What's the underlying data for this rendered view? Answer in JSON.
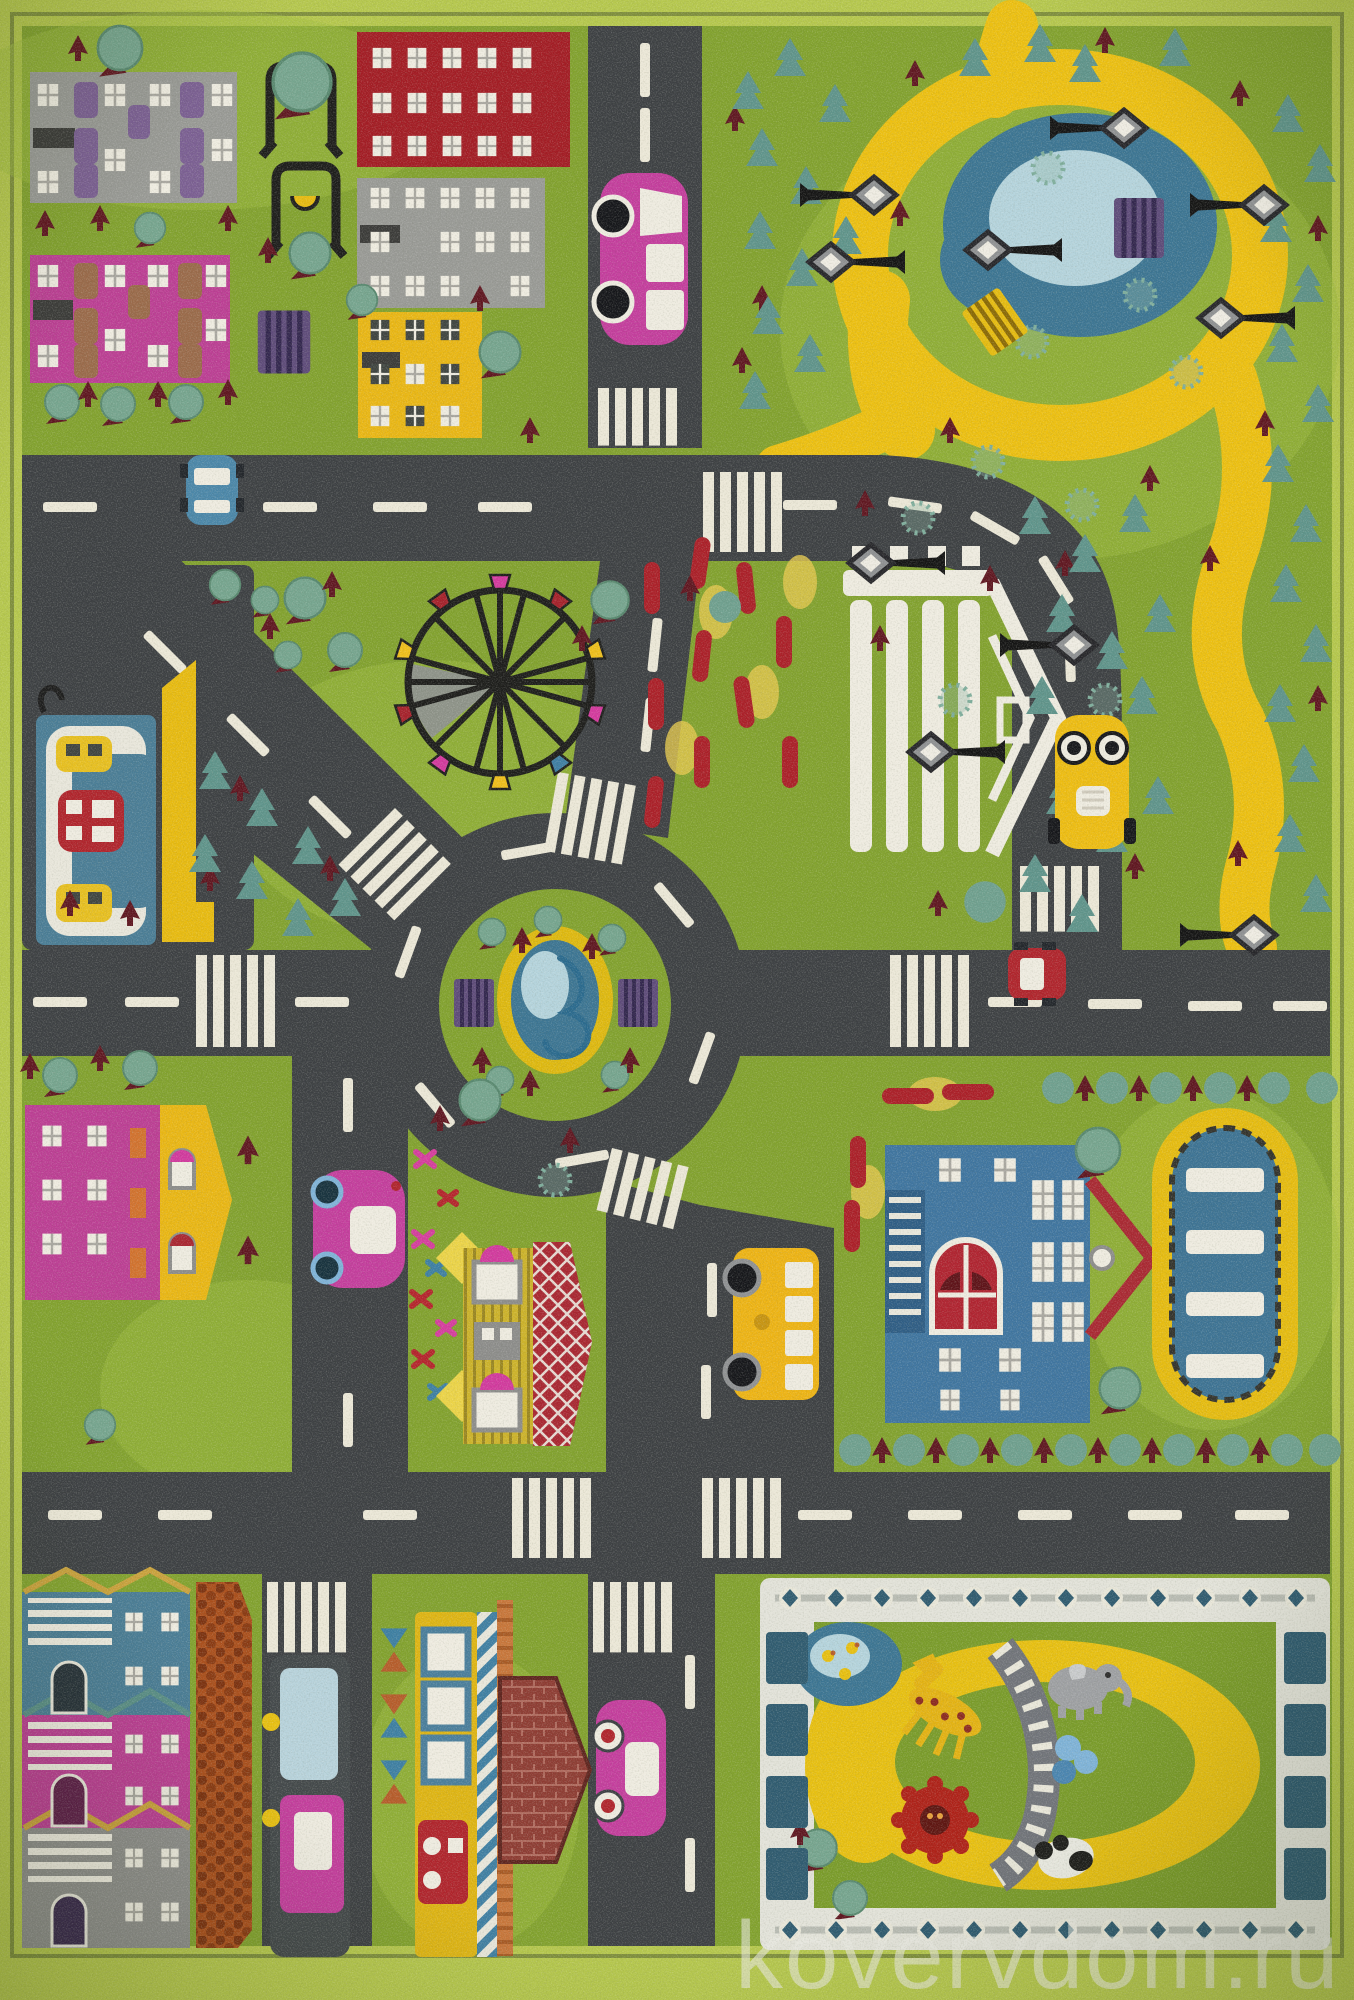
{
  "page": {
    "description": "Product photo of a children's city-road play rug, top-down view"
  },
  "watermark": {
    "text": "kovervdom.ru",
    "color": "#eaeae3"
  },
  "palette": {
    "border": "#b6c84d",
    "border_trim": "#7f8f3c",
    "grass": "#82a22e",
    "grass_light": "#9fbd40",
    "road": "#3d4043",
    "marking": "#ece8d8",
    "path": "#edc011",
    "pond": "#3c7593",
    "pond_light": "#b5d4dd",
    "tree": "#76a58f",
    "pine": "#5f948b",
    "trunk": "#5f1620",
    "building_red": "#a31c24",
    "building_pink": "#bc3e94",
    "building_yellow": "#eab714",
    "building_gray": "#999a96",
    "school_blue": "#3f75a0",
    "station_blue": "#4a7d96",
    "bench_purple": "#5e4b7a",
    "bench_yellow": "#e6bc10",
    "car_pink": "#c43d9d",
    "car_blue": "#4b87a9",
    "car_yellow": "#eebd12",
    "car_red": "#b0242c",
    "bus_yellow": "#eeb414",
    "cobblestone": "#aa4f1c",
    "zoo_fence": "#e3e3da",
    "zoo_post": "#2f5b70",
    "pool_water": "#3d7394",
    "flowerbed_red": "#ab1f28"
  },
  "scene": {
    "type": "children-play-rug-city-map",
    "objects": [
      "apartment-block-gray",
      "apartment-block-pink",
      "building-red",
      "building-gray",
      "building-yellow",
      "swing-frames",
      "park-pond",
      "park-path",
      "street-lamps",
      "park-benches",
      "pine-forest",
      "ferris-wheel",
      "roundabout",
      "fountain",
      "colonnade-pavilion",
      "flower-beds",
      "gas-station",
      "magenta-house",
      "school-house-red-roof",
      "school-building",
      "swimming-pool",
      "school-bus",
      "city-bus",
      "tram",
      "pink-cars",
      "blue-car",
      "yellow-taxi",
      "red-car",
      "row-houses",
      "cobblestone-yard",
      "brick-house",
      "zoo-enclosure",
      "giraffe",
      "elephant",
      "lion",
      "panda",
      "ducks"
    ]
  }
}
